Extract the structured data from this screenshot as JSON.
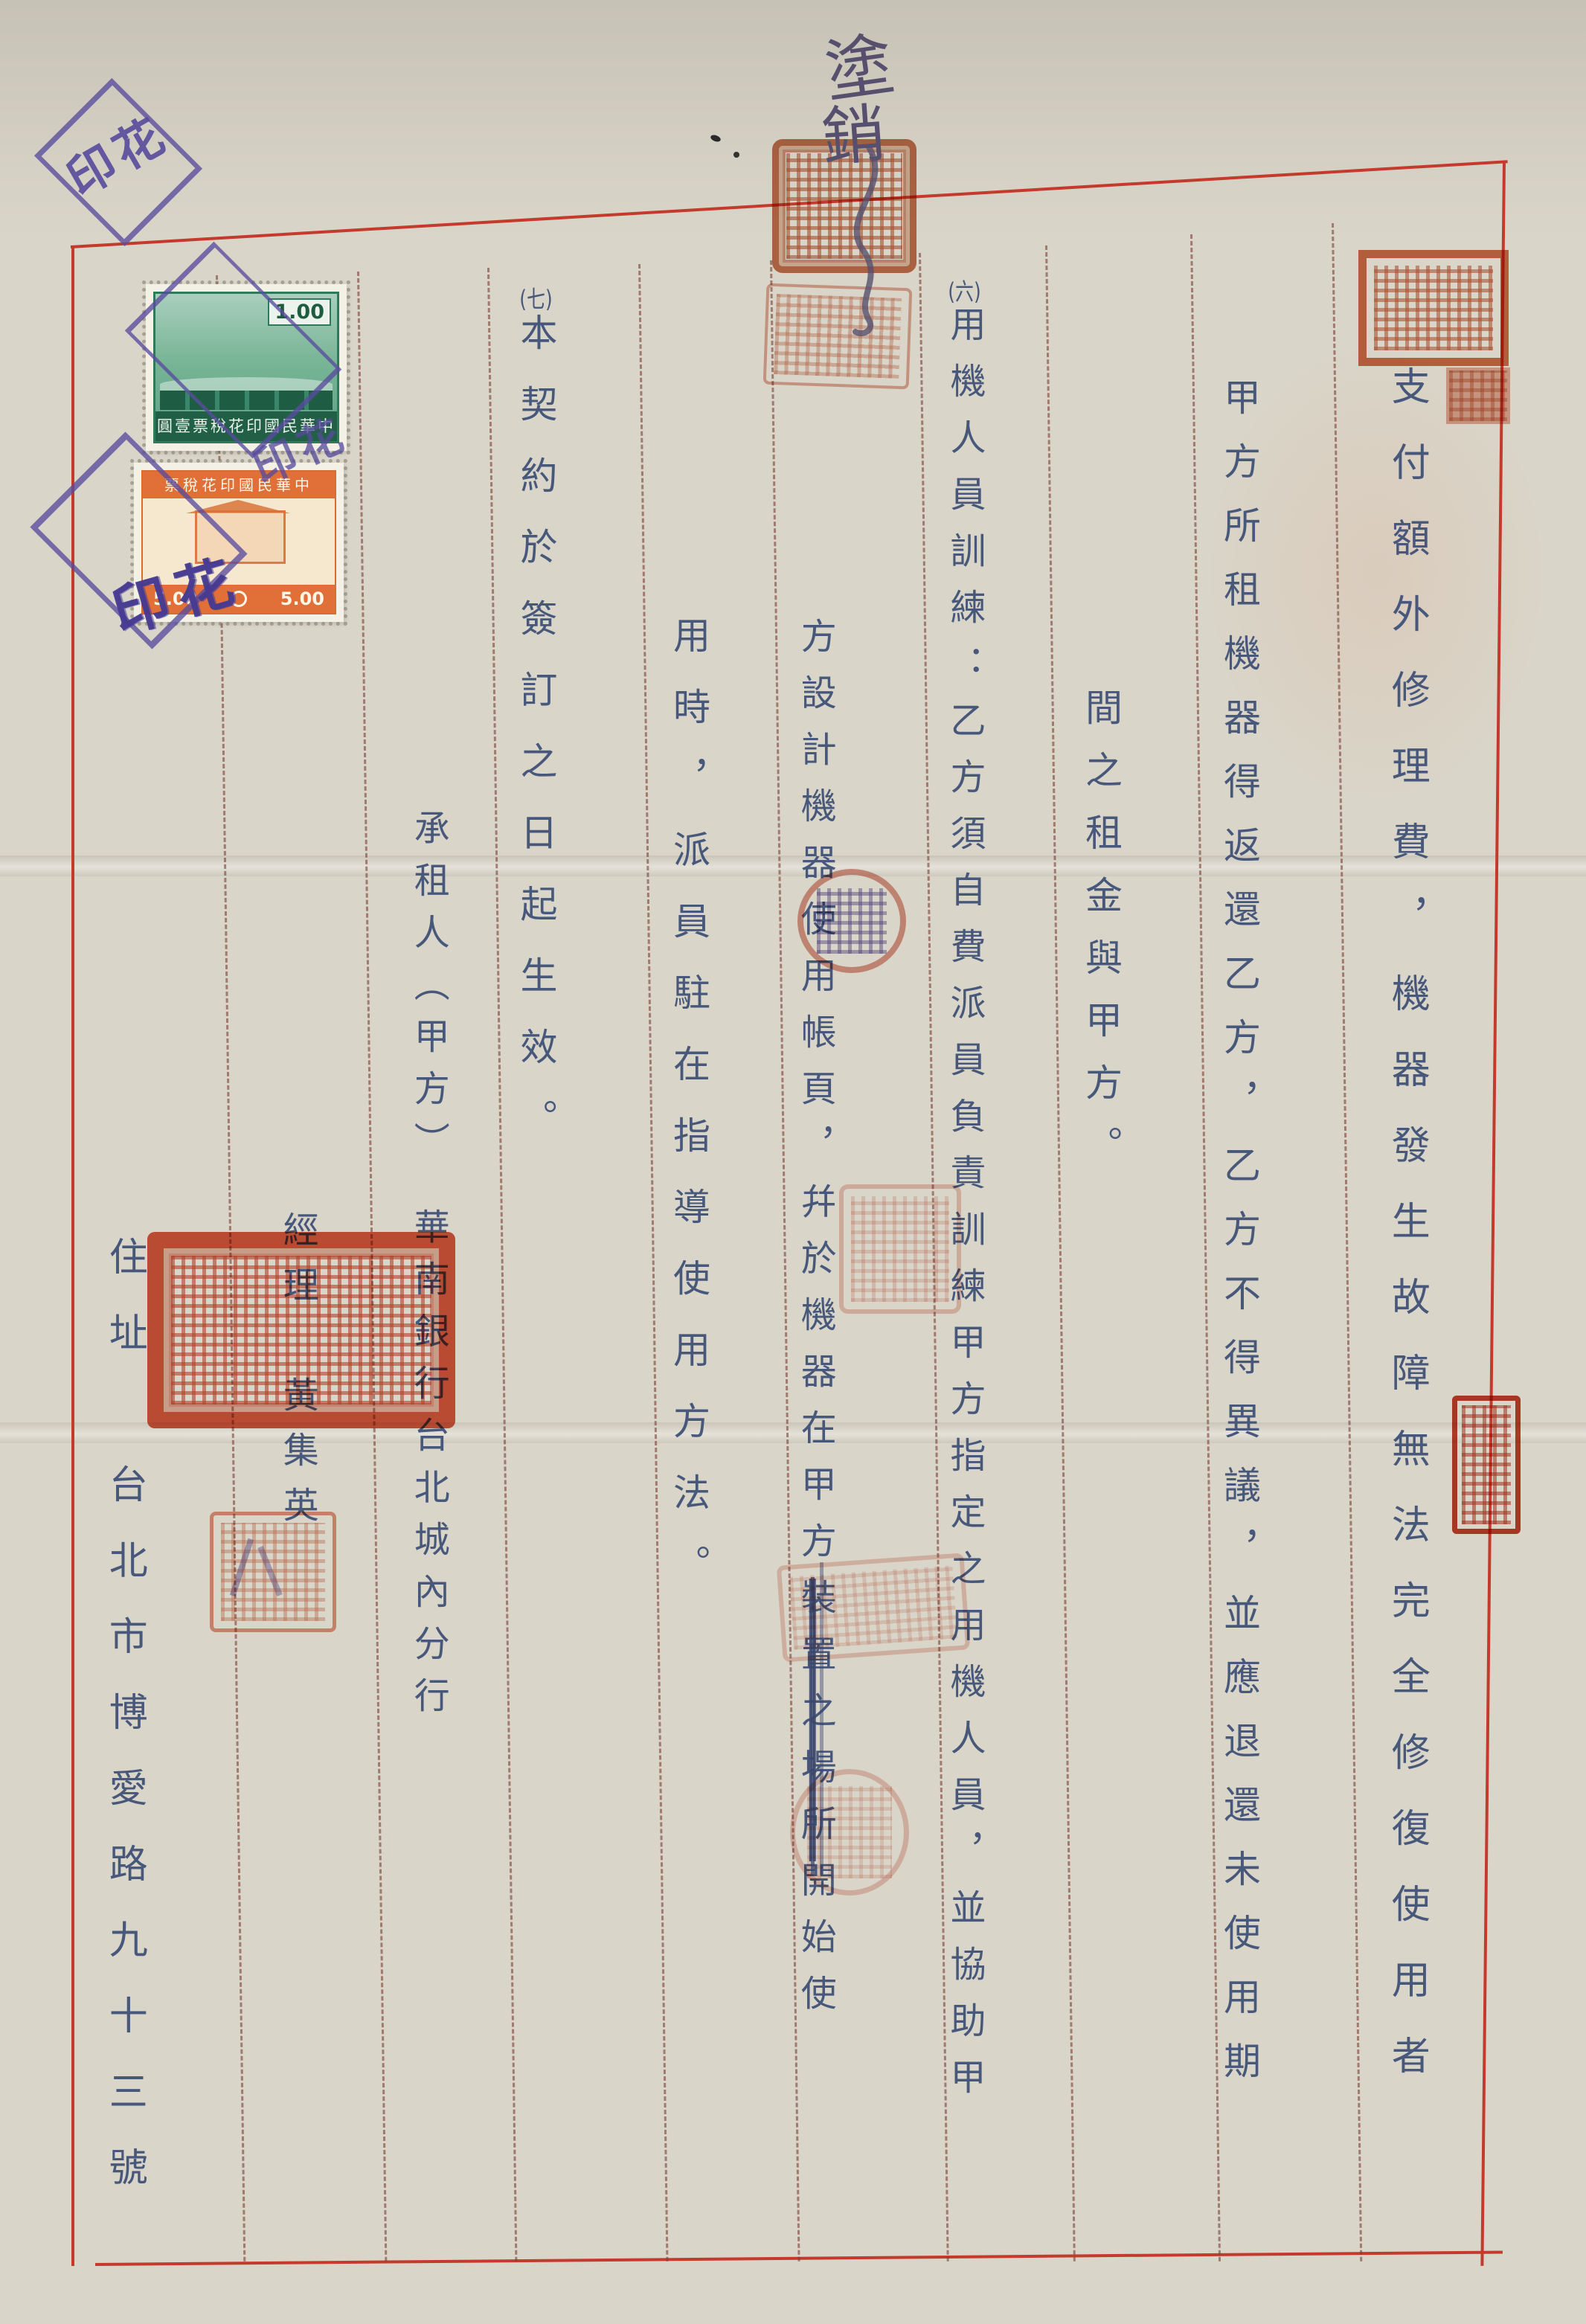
{
  "page": {
    "handwriting": {
      "char1": "塗",
      "char2": "銷"
    },
    "cancel_mark": "印花"
  },
  "columns": [
    {
      "text": "支付額外修理費，機器發生故障無法完全修復使用者"
    },
    {
      "text": "甲方所租機器得返還乙方，乙方不得異議，並應退還未使用期"
    },
    {
      "text": "間之租金與甲方。"
    },
    {
      "num": "(六)",
      "text": "用機人員訓練：乙方須自費派員負責訓練甲方指定之用機人員，並協助甲"
    },
    {
      "pre": "方設計機器使用帳頁，幷於機器在甲方",
      "struck": "裝置之場所",
      "post": "開始使"
    },
    {
      "text": "用時，派員駐在指導使用方法。"
    },
    {
      "num": "(七)",
      "text": "本契約於簽訂之日起生效。"
    },
    {
      "text": "承租人（甲方）　華南銀行台北城內分行"
    },
    {
      "text": "經理　黃集英"
    },
    {
      "text": "住址　台北市博愛路九十三號"
    }
  ],
  "stamps": {
    "green": {
      "value": "1.00",
      "band": "圓壹票稅花印國民華中"
    },
    "orange": {
      "band": "票稅花印國民華中",
      "value_left": "5.00",
      "value_right": "5.00"
    }
  }
}
